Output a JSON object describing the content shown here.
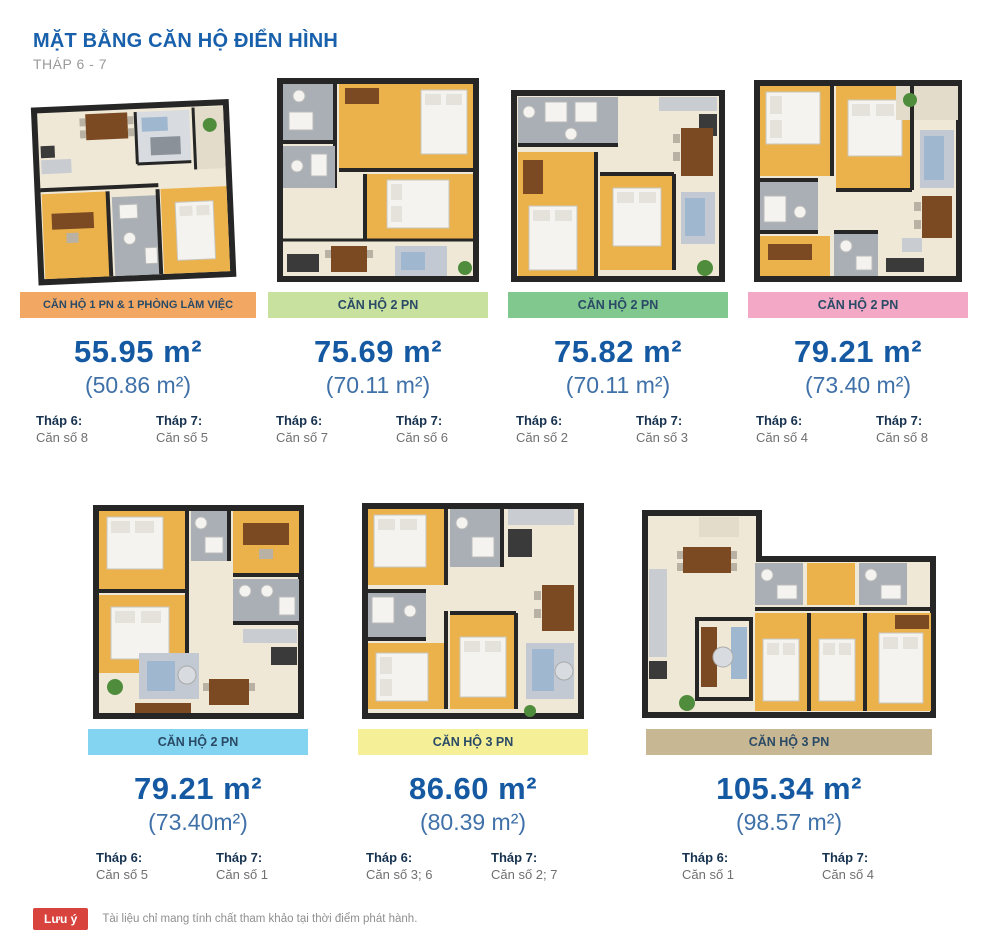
{
  "header": {
    "title": "MẶT BẰNG CĂN HỘ ĐIỂN HÌNH",
    "subtitle": "THÁP 6 - 7"
  },
  "units": [
    {
      "label": "CĂN HỘ 1 PN & 1 PHÒNG LÀM VIỆC",
      "label_bg": "#F2A862",
      "area": "55.95 m²",
      "area_sub": "(50.86 m²)",
      "thap6_label": "Tháp 6:",
      "thap6_value": "Căn số 8",
      "thap7_label": "Tháp 7:",
      "thap7_value": "Căn số 5"
    },
    {
      "label": "CĂN HỘ 2 PN",
      "label_bg": "#C9E19E",
      "area": "75.69 m²",
      "area_sub": "(70.11 m²)",
      "thap6_label": "Tháp 6:",
      "thap6_value": "Căn số 7",
      "thap7_label": "Tháp 7:",
      "thap7_value": "Căn số 6"
    },
    {
      "label": "CĂN HỘ 2 PN",
      "label_bg": "#81C88E",
      "area": "75.82 m²",
      "area_sub": "(70.11 m²)",
      "thap6_label": "Tháp 6:",
      "thap6_value": "Căn số 2",
      "thap7_label": "Tháp 7:",
      "thap7_value": "Căn số 3"
    },
    {
      "label": "CĂN HỘ 2 PN",
      "label_bg": "#F3A9C5",
      "area": "79.21 m²",
      "area_sub": "(73.40 m²)",
      "thap6_label": "Tháp 6:",
      "thap6_value": "Căn số 4",
      "thap7_label": "Tháp 7:",
      "thap7_value": "Căn số 8"
    },
    {
      "label": "CĂN HỘ 2 PN",
      "label_bg": "#83D4F1",
      "area": "79.21 m²",
      "area_sub": "(73.40m²)",
      "thap6_label": "Tháp 6:",
      "thap6_value": "Căn số 5",
      "thap7_label": "Tháp 7:",
      "thap7_value": "Căn số 1"
    },
    {
      "label": "CĂN HỘ 3 PN",
      "label_bg": "#F5F098",
      "area": "86.60 m²",
      "area_sub": "(80.39 m²)",
      "thap6_label": "Tháp 6:",
      "thap6_value": "Căn số 3; 6",
      "thap7_label": "Tháp 7:",
      "thap7_value": "Căn số 2; 7"
    },
    {
      "label": "CĂN HỘ 3 PN",
      "label_bg": "#C7B792",
      "area": "105.34 m²",
      "area_sub": "(98.57 m²)",
      "thap6_label": "Tháp 6:",
      "thap6_value": "Căn số 1",
      "thap7_label": "Tháp 7:",
      "thap7_value": "Căn số 4"
    }
  ],
  "note": {
    "badge": "Lưu ý",
    "text": "Tài liệu chỉ mang tính chất tham khảo tại thời điểm phát hành."
  },
  "colors": {
    "title_blue": "#1860AB",
    "area_blue": "#1459A2",
    "area_sub_blue": "#3F71A8",
    "label_text": "#2A4A66",
    "tower_label": "#16324F",
    "tower_value": "#6F6F6F",
    "note_red": "#D8433D",
    "subtitle_gray": "#9A9A9A",
    "plan_wall": "#262626",
    "plan_floor": "#EFE8D7",
    "plan_wood": "#EBB24B",
    "plan_bath": "#A9AFB4",
    "plan_furniture": "#7B4A22",
    "plan_plant": "#4F8C3C"
  }
}
